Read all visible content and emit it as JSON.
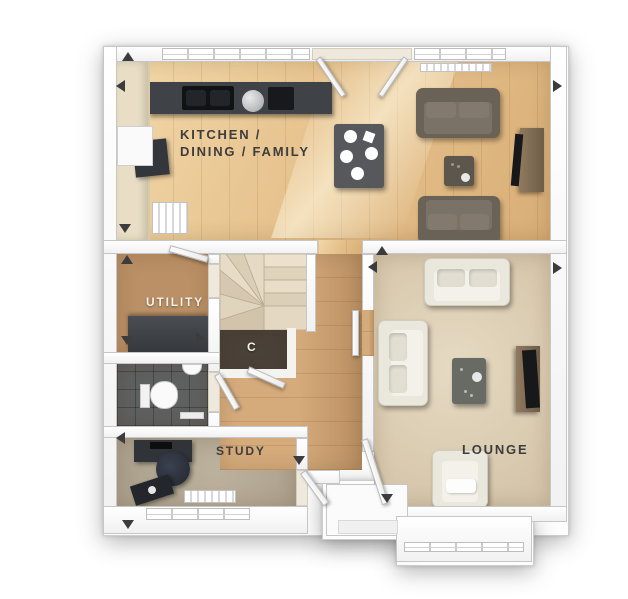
{
  "plan": {
    "view": "top-down 3D floor plan",
    "labels": {
      "kitchen_line1": "KITCHEN /",
      "kitchen_line2": "DINING / FAMILY",
      "utility": "UTILITY",
      "cupboard": "C",
      "study": "STUDY",
      "lounge": "LOUNGE"
    }
  },
  "colors": {
    "wood": "#e6c28e",
    "woodLight": "#f2d8a8",
    "woodShade": "#d9ae77",
    "woodHall": "#d5ab7c",
    "woodHallShade": "#b98f62",
    "woodUtility": "#bb9066",
    "carpetStairs": "#e2d6c0",
    "carpetLounge": "#d5c5aa",
    "carpetLoungeLight": "#e6dac2",
    "carpetStudy": "#ada28e",
    "carpetStudyLight": "#bcb19d",
    "tile": "#5f6060",
    "wallEdge": "#c6c6c6",
    "counter": "#3f4247",
    "cabinet": "#e9dec5",
    "sofaDark": "#6a6157",
    "sofaDarkSeat": "#7b7267",
    "sofaCream": "#eae7dd",
    "sofaCreamSeat": "#f3f1ea",
    "tableDark": "#56585c",
    "chairDark": "#3f4145",
    "tv": "#17181a",
    "tvWood": "#8f7a5f",
    "cupboard": "#4a4138",
    "labelDark": "#3d3d3d",
    "labelLight": "#f4f2ec",
    "arrow": "#3c3c3c"
  }
}
